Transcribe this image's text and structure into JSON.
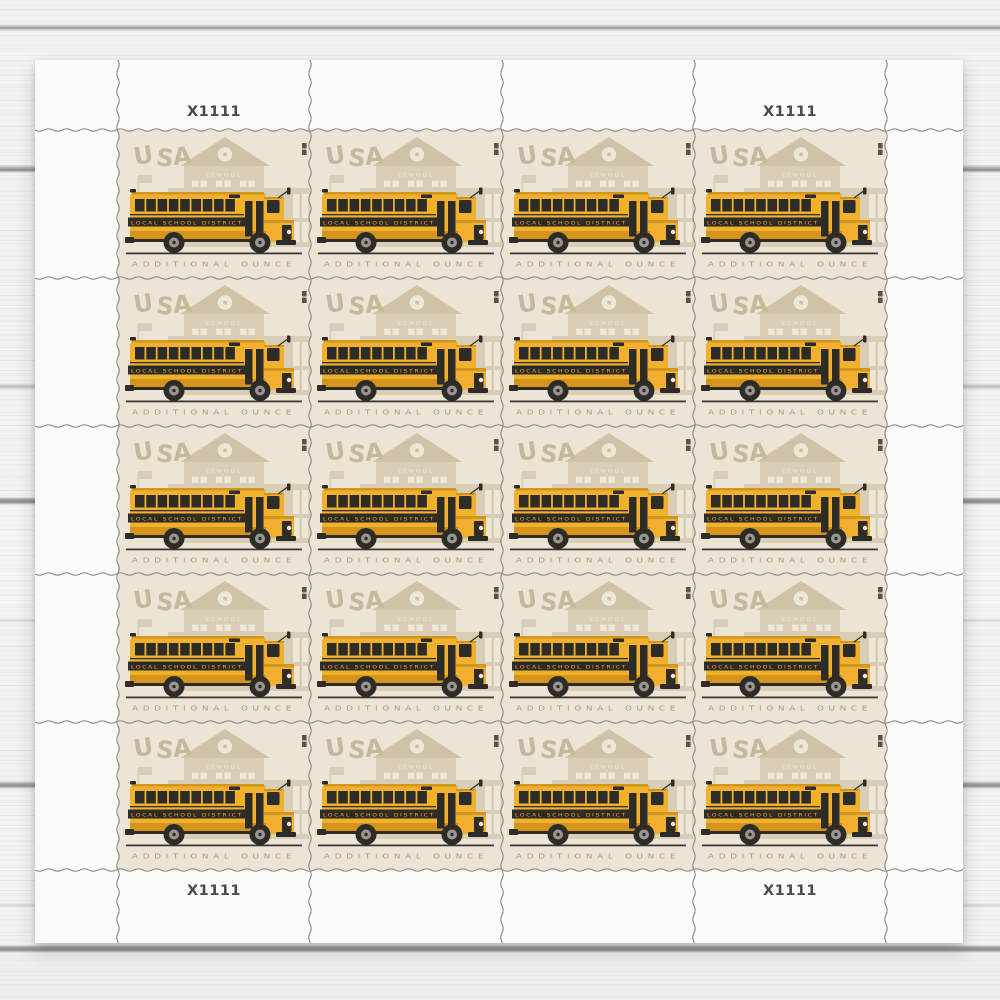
{
  "scene": {
    "subject": "Sheet of 20 school-bus postage stamps on a white wood plank surface"
  },
  "sheet": {
    "plate_numbers": {
      "top_left": "X1111",
      "top_right": "X1111",
      "bottom_left": "X1111",
      "bottom_right": "X1111"
    },
    "grid": {
      "rows": 5,
      "columns": 4,
      "stamp_count": 20
    },
    "stamp": {
      "country": "USA",
      "building_sign": "SCHOOL",
      "bus_text": "LOCAL SCHOOL DISTRICT",
      "service_text": "ADDITIONAL OUNCE",
      "colors": {
        "paper": "#ece4d5",
        "building": "#d8cdb5",
        "building_shadow": "#cfc2a7",
        "window_cream": "#eee7d8",
        "usa_text": "#c6b89c",
        "service_text_color": "#ab9d80",
        "bus_yellow": "#f1b02e",
        "bus_dark_yellow": "#d5951d",
        "bus_black": "#2e2c27",
        "wheel_hub": "#999693",
        "road": "#3a3833",
        "microprint": "#57544c",
        "perforation": "#8c8b87"
      }
    }
  }
}
